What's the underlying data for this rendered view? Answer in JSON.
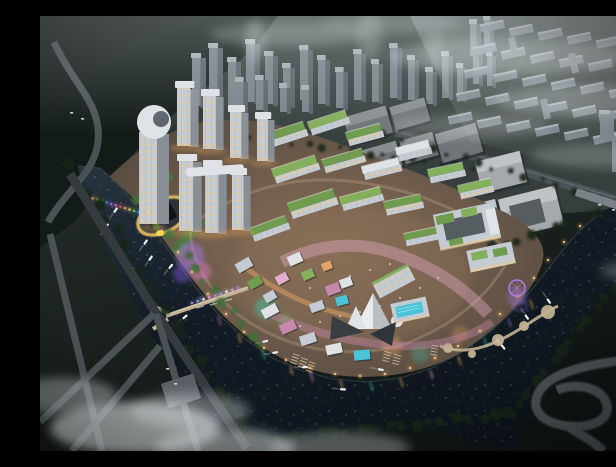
{
  "meta": {
    "description": "Aerial dusk rendering of a riverfront mixed-use masterplan: illuminated tower cluster and green-roofed mid-rise blocks wrapped by a dark river, hazy grey city and housing blocks behind, highway loop ramp at lower right, fog banks at lower left",
    "scene_type": "architectural-rendering",
    "time_of_day": "dusk"
  },
  "palette": {
    "base-top": "#4a5553",
    "base-mid": "#232b28",
    "base-dark": "#0f1615",
    "forest": "#131b19",
    "forest-deep": "#0b1211",
    "city-ground": "#3a4340",
    "city-front": "#79828a",
    "city-side": "#59626a",
    "city-top": "#a6adb4",
    "housing": "#7b838c",
    "housing-top": "#aab1b8",
    "wh-dark": "#6e7478",
    "wh-dark-top": "#888e92",
    "wh-pale": "#a4a9ad",
    "wh-pale-top": "#bfc3c6",
    "wh-inner": "#565d60",
    "road": "#4b5256",
    "road-light": "#7a8187",
    "road-dark": "#343a3e",
    "bridge-tan": "#c2b192",
    "water-deep": "#121b24",
    "water-mid": "#273340",
    "water-edge": "#5a6a78",
    "dev-ground": "#4e453c",
    "dev-lit": "#8a6f58",
    "facade": "#c4cbd2",
    "facade-light": "#dfe3e7",
    "facade-side": "#878e96",
    "window-warm": "#eccd97",
    "roof-green": "#6f9c4e",
    "roof-green2": "#84af5c",
    "lawn": "#4c7a41",
    "plaza-pink": "#e5accb",
    "plaza-pink2": "#c788ae",
    "path-orange": "#e2a366",
    "pool-teal": "#4cc4d8",
    "tree-dark": "#16211a",
    "tree-bright": "#3e6e36",
    "cloud": "#e2e9ea",
    "glow-purple": "#a678e8",
    "glow-magenta": "#e078c8",
    "glow-violet": "#7e5ad8",
    "glow-teal": "#3fd4b4",
    "glow-green": "#56d65e",
    "glow-orange": "#ffb45e",
    "glow-pink": "#ff9ad0",
    "gold": "#c9a64f",
    "slab-dark": "#101417",
    "boat": "#eaf0f4",
    "ferris": "#b07ae8"
  },
  "scene": {
    "background": {
      "towers": [
        [
          152,
          40,
          14,
          50
        ],
        [
          169,
          30,
          14,
          58
        ],
        [
          188,
          44,
          13,
          46
        ],
        [
          206,
          26,
          14,
          60
        ],
        [
          225,
          38,
          13,
          50
        ],
        [
          243,
          50,
          12,
          40
        ],
        [
          260,
          32,
          13,
          52
        ],
        [
          278,
          42,
          12,
          46
        ],
        [
          296,
          54,
          12,
          38
        ],
        [
          314,
          36,
          12,
          48
        ],
        [
          332,
          46,
          11,
          40
        ],
        [
          350,
          30,
          12,
          52
        ],
        [
          368,
          42,
          11,
          42
        ],
        [
          386,
          54,
          11,
          34
        ],
        [
          402,
          38,
          11,
          44
        ],
        [
          417,
          50,
          10,
          34
        ],
        [
          433,
          28,
          10,
          40
        ],
        [
          447,
          38,
          9,
          32
        ],
        [
          196,
          64,
          12,
          34
        ],
        [
          216,
          62,
          12,
          32
        ],
        [
          240,
          70,
          11,
          26
        ],
        [
          262,
          72,
          11,
          24
        ],
        [
          430,
          6,
          11,
          34
        ],
        [
          444,
          2,
          10,
          28
        ]
      ],
      "housing": {
        "origin": [
          440,
          10
        ],
        "cols": 6,
        "rows": 5,
        "col_step": [
          29,
          4
        ],
        "row_step": [
          -8,
          23
        ],
        "bar": [
          24,
          7
        ],
        "rot": -12
      },
      "verticals": [
        [
          468,
          22
        ],
        [
          528,
          38
        ],
        [
          586,
          54
        ],
        [
          500,
          84
        ],
        [
          558,
          98
        ],
        [
          608,
          68
        ]
      ],
      "warehouses": [
        [
          306,
          95,
          44,
          28,
          -16,
          "dark"
        ],
        [
          352,
          86,
          36,
          24,
          -16,
          "dark"
        ],
        [
          318,
          130,
          42,
          26,
          -16,
          "dark"
        ],
        [
          362,
          120,
          34,
          24,
          -16,
          "dark"
        ],
        [
          398,
          112,
          42,
          30,
          -16,
          "dark"
        ],
        [
          438,
          140,
          46,
          32,
          -14,
          "pale"
        ],
        [
          462,
          176,
          58,
          40,
          -14,
          "paleU"
        ],
        [
          430,
          186,
          28,
          22,
          -14,
          "pale"
        ]
      ],
      "right_blocks": [
        [
          572,
          118,
          18,
          38
        ],
        [
          594,
          132,
          16,
          30
        ],
        [
          560,
          96,
          14,
          26
        ]
      ]
    },
    "development": {
      "lit_towers": [
        [
          137,
          70,
          21,
          60
        ],
        [
          163,
          78,
          20,
          55
        ],
        [
          190,
          94,
          18,
          48
        ],
        [
          217,
          101,
          17,
          44
        ],
        [
          139,
          143,
          22,
          72
        ],
        [
          165,
          149,
          21,
          68
        ],
        [
          192,
          157,
          18,
          57
        ]
      ],
      "midrise": [
        [
          222,
          112,
          44,
          13,
          -18,
          "g"
        ],
        [
          268,
          100,
          40,
          12,
          -18,
          "g2"
        ],
        [
          306,
          112,
          36,
          12,
          -15,
          "g"
        ],
        [
          232,
          146,
          46,
          13,
          -18,
          "g2"
        ],
        [
          282,
          138,
          42,
          12,
          -16,
          "g"
        ],
        [
          322,
          146,
          38,
          12,
          -14,
          "p"
        ],
        [
          248,
          180,
          48,
          14,
          -18,
          "g"
        ],
        [
          300,
          176,
          42,
          12,
          -15,
          "g2"
        ],
        [
          344,
          182,
          38,
          12,
          -12,
          "g"
        ],
        [
          356,
          128,
          34,
          12,
          -14,
          "p"
        ],
        [
          388,
          150,
          36,
          12,
          -12,
          "g2"
        ],
        [
          210,
          206,
          38,
          12,
          -20,
          "g"
        ],
        [
          364,
          214,
          36,
          11,
          -12,
          "g"
        ],
        [
          418,
          166,
          34,
          12,
          -13,
          "g2"
        ]
      ],
      "retail": [
        [
          286,
          268,
          14,
          10,
          -20,
          "plaza-pink2"
        ],
        [
          300,
          262,
          12,
          9,
          -20,
          "facade-light"
        ],
        [
          296,
          280,
          12,
          9,
          -15,
          "pool-teal"
        ],
        [
          270,
          286,
          14,
          9,
          -20,
          "facade"
        ],
        [
          262,
          254,
          12,
          9,
          -24,
          "roof-green2"
        ],
        [
          248,
          238,
          14,
          10,
          -24,
          "facade-light"
        ],
        [
          236,
          258,
          12,
          9,
          -28,
          "plaza-pink"
        ],
        [
          224,
          276,
          12,
          9,
          -30,
          "facade"
        ],
        [
          282,
          246,
          10,
          8,
          -20,
          "path-orange"
        ],
        [
          196,
          244,
          16,
          10,
          -30,
          "facade"
        ],
        [
          208,
          262,
          14,
          9,
          -30,
          "roof-green"
        ],
        [
          222,
          290,
          16,
          10,
          -28,
          "facade-light"
        ],
        [
          240,
          306,
          16,
          10,
          -24,
          "plaza-pink2"
        ],
        [
          260,
          318,
          16,
          10,
          -18,
          "facade"
        ],
        [
          286,
          328,
          16,
          10,
          -12,
          "facade-light"
        ],
        [
          314,
          334,
          16,
          10,
          -6,
          "pool-teal"
        ]
      ],
      "lawns": [
        [
          96,
          168,
          42,
          12
        ],
        [
          110,
          190,
          46,
          12
        ],
        [
          126,
          214,
          44,
          12
        ]
      ],
      "street_lights": [
        [
          108,
          196
        ],
        [
          122,
          215
        ],
        [
          138,
          236
        ],
        [
          152,
          256
        ],
        [
          168,
          278
        ],
        [
          186,
          298
        ],
        [
          204,
          316
        ],
        [
          224,
          332
        ],
        [
          246,
          344
        ],
        [
          270,
          352
        ],
        [
          295,
          358
        ],
        [
          320,
          360
        ],
        [
          345,
          358
        ],
        [
          370,
          352
        ],
        [
          395,
          342
        ],
        [
          418,
          330
        ],
        [
          440,
          315
        ],
        [
          460,
          298
        ],
        [
          478,
          280
        ],
        [
          494,
          262
        ],
        [
          508,
          244
        ],
        [
          524,
          226
        ],
        [
          540,
          210
        ]
      ],
      "plaza_dots": [
        [
          300,
          300
        ],
        [
          320,
          296
        ],
        [
          340,
          290
        ],
        [
          280,
          306
        ],
        [
          260,
          310
        ],
        [
          360,
          282
        ],
        [
          380,
          272
        ],
        [
          398,
          262
        ],
        [
          310,
          260
        ],
        [
          330,
          254
        ],
        [
          350,
          248
        ],
        [
          270,
          272
        ]
      ]
    },
    "water": {
      "boats": [
        [
          73,
          196,
          -55
        ],
        [
          64,
          212,
          -55
        ],
        [
          103,
          228,
          -55
        ],
        [
          108,
          244,
          -55
        ],
        [
          128,
          252,
          -50
        ],
        [
          142,
          302,
          -40
        ],
        [
          222,
          325,
          -15
        ],
        [
          232,
          336,
          -10
        ],
        [
          262,
          350,
          0
        ],
        [
          300,
          372,
          5
        ],
        [
          338,
          352,
          10
        ],
        [
          462,
          328,
          50
        ],
        [
          486,
          298,
          55
        ],
        [
          508,
          282,
          55
        ]
      ],
      "glows": [
        [
          150,
          240,
          14,
          "glow-purple",
          0.5
        ],
        [
          161,
          256,
          10,
          "glow-magenta",
          0.5
        ],
        [
          142,
          258,
          9,
          "glow-violet",
          0.45
        ],
        [
          226,
          292,
          11,
          "glow-teal",
          0.4
        ],
        [
          246,
          306,
          8,
          "glow-green",
          0.3
        ],
        [
          380,
          338,
          9,
          "glow-teal",
          0.25
        ],
        [
          352,
          330,
          10,
          "glow-orange",
          0.3
        ],
        [
          420,
          318,
          8,
          "glow-orange",
          0.25
        ],
        [
          477,
          281,
          10,
          "glow-purple",
          0.35
        ]
      ],
      "rainbow": {
        "from": [
          48,
          181
        ],
        "to": [
          108,
          199
        ],
        "count": 14,
        "colors": [
          "#e05a5a",
          "#e8a24a",
          "#ece05a",
          "#6ad06a",
          "#5a9fe8",
          "#8a6fe0",
          "#d66ad0"
        ]
      },
      "weir": {
        "from": [
          152,
          287
        ],
        "to": [
          198,
          272
        ],
        "count": 9,
        "colors": [
          "#b48ae8",
          "#8ab4f0",
          "#ffffff",
          "#e8a0e0"
        ]
      },
      "reflections": [
        [
          250,
          350,
          "glow-orange"
        ],
        [
          270,
          356,
          "glow-pink"
        ],
        [
          300,
          364,
          "glow-orange"
        ],
        [
          330,
          366,
          "glow-teal"
        ],
        [
          360,
          362,
          "glow-orange"
        ],
        [
          390,
          354,
          "glow-pink"
        ],
        [
          418,
          340,
          "glow-orange"
        ],
        [
          444,
          322,
          "glow-teal"
        ],
        [
          468,
          302,
          "glow-purple"
        ],
        [
          490,
          284,
          "glow-orange"
        ],
        [
          160,
          280,
          "glow-purple"
        ],
        [
          178,
          300,
          "glow-magenta"
        ],
        [
          198,
          318,
          "glow-orange"
        ],
        [
          222,
          334,
          "glow-teal"
        ]
      ],
      "pier_nodes": [
        [
          408,
          332,
          5
        ],
        [
          432,
          338,
          4
        ],
        [
          458,
          324,
          6
        ],
        [
          484,
          310,
          5
        ],
        [
          508,
          296,
          7
        ]
      ],
      "dock_ticks": [
        [
          250,
          346,
          -70
        ],
        [
          258,
          350,
          -70
        ],
        [
          266,
          354,
          -70
        ],
        [
          342,
          344,
          -75
        ],
        [
          352,
          347,
          -75
        ],
        [
          390,
          338,
          -80
        ]
      ]
    },
    "trees": {
      "strips": [
        {
          "from": [
            32,
            150
          ],
          "to": [
            212,
            425
          ],
          "count": 22,
          "r": 6,
          "key": "tree-dark"
        },
        {
          "from": [
            212,
            425
          ],
          "to": [
            470,
            398
          ],
          "count": 20,
          "r": 6,
          "key": "tree-dark"
        },
        {
          "from": [
            470,
            398
          ],
          "to": [
            600,
            240
          ],
          "count": 16,
          "r": 6,
          "key": "tree-dark"
        },
        {
          "from": [
            455,
            232
          ],
          "to": [
            560,
            196
          ],
          "count": 10,
          "r": 5,
          "key": "tree-dark"
        },
        {
          "from": [
            345,
            120
          ],
          "to": [
            610,
            196
          ],
          "count": 18,
          "r": 4,
          "key": "tree-dark"
        },
        {
          "from": [
            152,
            112
          ],
          "to": [
            430,
            152
          ],
          "count": 20,
          "r": 4,
          "key": "tree-dark"
        },
        {
          "from": [
            100,
            186
          ],
          "to": [
            220,
            330
          ],
          "count": 14,
          "r": 5,
          "key": "tree-bright"
        }
      ]
    },
    "clouds": [
      [
        95,
        412,
        85,
        26,
        0.65
      ],
      [
        185,
        432,
        70,
        20,
        0.5
      ],
      [
        22,
        380,
        55,
        18,
        0.4
      ],
      [
        150,
        395,
        60,
        18,
        0.35
      ],
      [
        300,
        432,
        70,
        16,
        0.35
      ],
      [
        470,
        40,
        120,
        18,
        0.3
      ],
      [
        545,
        85,
        90,
        16,
        0.28
      ],
      [
        430,
        110,
        80,
        12,
        0.22
      ],
      [
        250,
        18,
        80,
        12,
        0.25
      ],
      [
        350,
        8,
        70,
        10,
        0.2
      ],
      [
        600,
        255,
        40,
        10,
        0.25
      ],
      [
        560,
        140,
        70,
        12,
        0.22
      ],
      [
        215,
        25,
        10,
        22,
        0.3
      ],
      [
        330,
        20,
        12,
        25,
        0.25
      ],
      [
        395,
        35,
        10,
        20,
        0.22
      ]
    ],
    "cars": [
      [
        30,
        96
      ],
      [
        41,
        102
      ],
      [
        558,
        188
      ],
      [
        572,
        193
      ],
      [
        586,
        197
      ],
      [
        126,
        352
      ],
      [
        134,
        367
      ]
    ]
  }
}
